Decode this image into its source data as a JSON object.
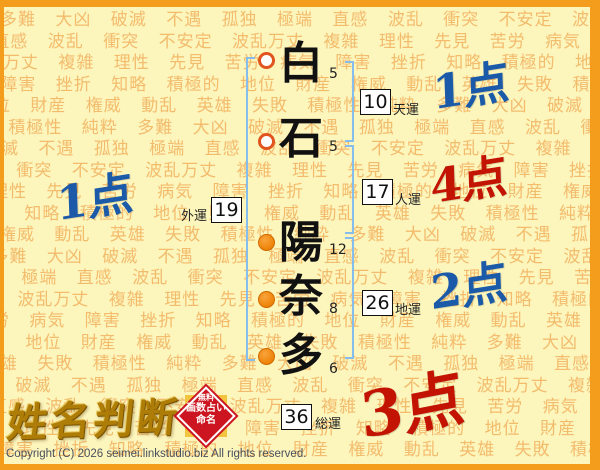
{
  "name": {
    "chars": [
      {
        "char": "白",
        "strokes": "5",
        "part": "surname"
      },
      {
        "char": "石",
        "strokes": "5",
        "part": "surname"
      },
      {
        "char": "陽",
        "strokes": "12",
        "part": "given"
      },
      {
        "char": "奈",
        "strokes": "8",
        "part": "given"
      },
      {
        "char": "多",
        "strokes": "6",
        "part": "given"
      }
    ]
  },
  "fortunes": {
    "tenun": {
      "label": "天運",
      "value": "10",
      "score": "1点",
      "score_color": "#1A5AA8"
    },
    "jinun": {
      "label": "人運",
      "value": "17",
      "score": "4点",
      "score_color": "#C21303"
    },
    "chiun": {
      "label": "地運",
      "value": "26",
      "score": "2点",
      "score_color": "#1A5AA8"
    },
    "gaiun": {
      "label": "外運",
      "value": "19",
      "score": "1点",
      "score_color": "#1A5AA8"
    },
    "souun": {
      "label": "総運",
      "value": "36",
      "score": "3点",
      "score_color": "#C21303"
    }
  },
  "logo": {
    "title": "姓名判断",
    "seal": {
      "lines": [
        "無料",
        "画数占い",
        "命名"
      ]
    }
  },
  "footer": {
    "copyright": "Copyright (C) 2026 seimei.linkstudio.biz All rights reserved."
  },
  "background": {
    "words": [
      "多難",
      "大凶",
      "破滅",
      "不遇",
      "孤独",
      "極端",
      "直感",
      "波乱",
      "衝突",
      "不安定",
      "波乱万丈",
      "複雑",
      "理性",
      "先見",
      "苦労",
      "病気",
      "障害",
      "挫折",
      "知略",
      "積極的",
      "地位",
      "財産",
      "権威",
      "動乱",
      "英雄",
      "失敗",
      "積極性",
      "純粋"
    ]
  },
  "colors": {
    "frame_orange": "#F49C1C",
    "background_yellow": "#FCF5BC",
    "pattern_text": "#F1AD58",
    "bracket_blue": "#85BEEC",
    "surname_ring": "#E2541E",
    "given_fill": "#EE8408",
    "score_blue": "#1A5AA8",
    "score_red": "#C21303",
    "seal_red": "#CC1520",
    "logo_gold": "#AE7D08"
  }
}
